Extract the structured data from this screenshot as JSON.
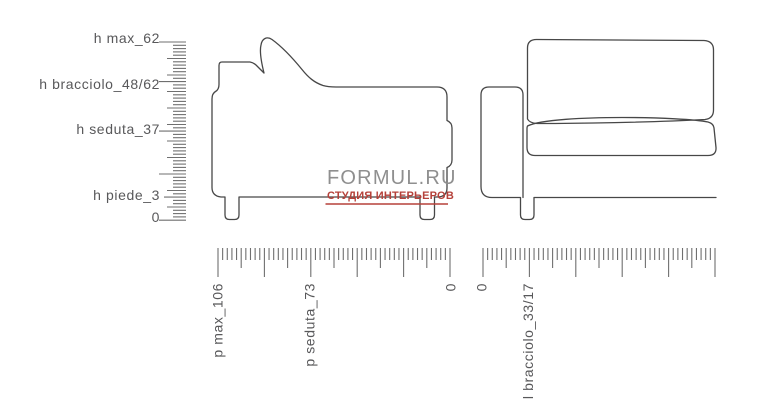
{
  "watermark": {
    "brand": "FORMUL.RU",
    "tagline": "СТУДИЯ ИНТЕРЬЕРОВ"
  },
  "rulers": {
    "height": {
      "orientation": "vertical",
      "labels": [
        "h max_62",
        "h bracciolo_48/62",
        "h seduta_37",
        "h piede_3",
        "0"
      ]
    },
    "depth": {
      "orientation": "horizontal",
      "labels": [
        "p max_106",
        "p seduta_73",
        "0"
      ]
    },
    "width": {
      "orientation": "horizontal",
      "labels": [
        "0",
        "l bracciolo_33/17"
      ]
    }
  },
  "measurements": {
    "h_max": "62",
    "h_bracciolo": "48/62",
    "h_seduta": "37",
    "h_piede": "3",
    "p_max": "106",
    "p_seduta": "73",
    "l_bracciolo": "33/17"
  },
  "colors": {
    "outline": "#474747",
    "ruler_tick": "#6f6f6f",
    "label_text": "#58585a",
    "watermark_brand": "#8f8f8f",
    "watermark_accent": "#b5413a",
    "background": "#ffffff"
  }
}
